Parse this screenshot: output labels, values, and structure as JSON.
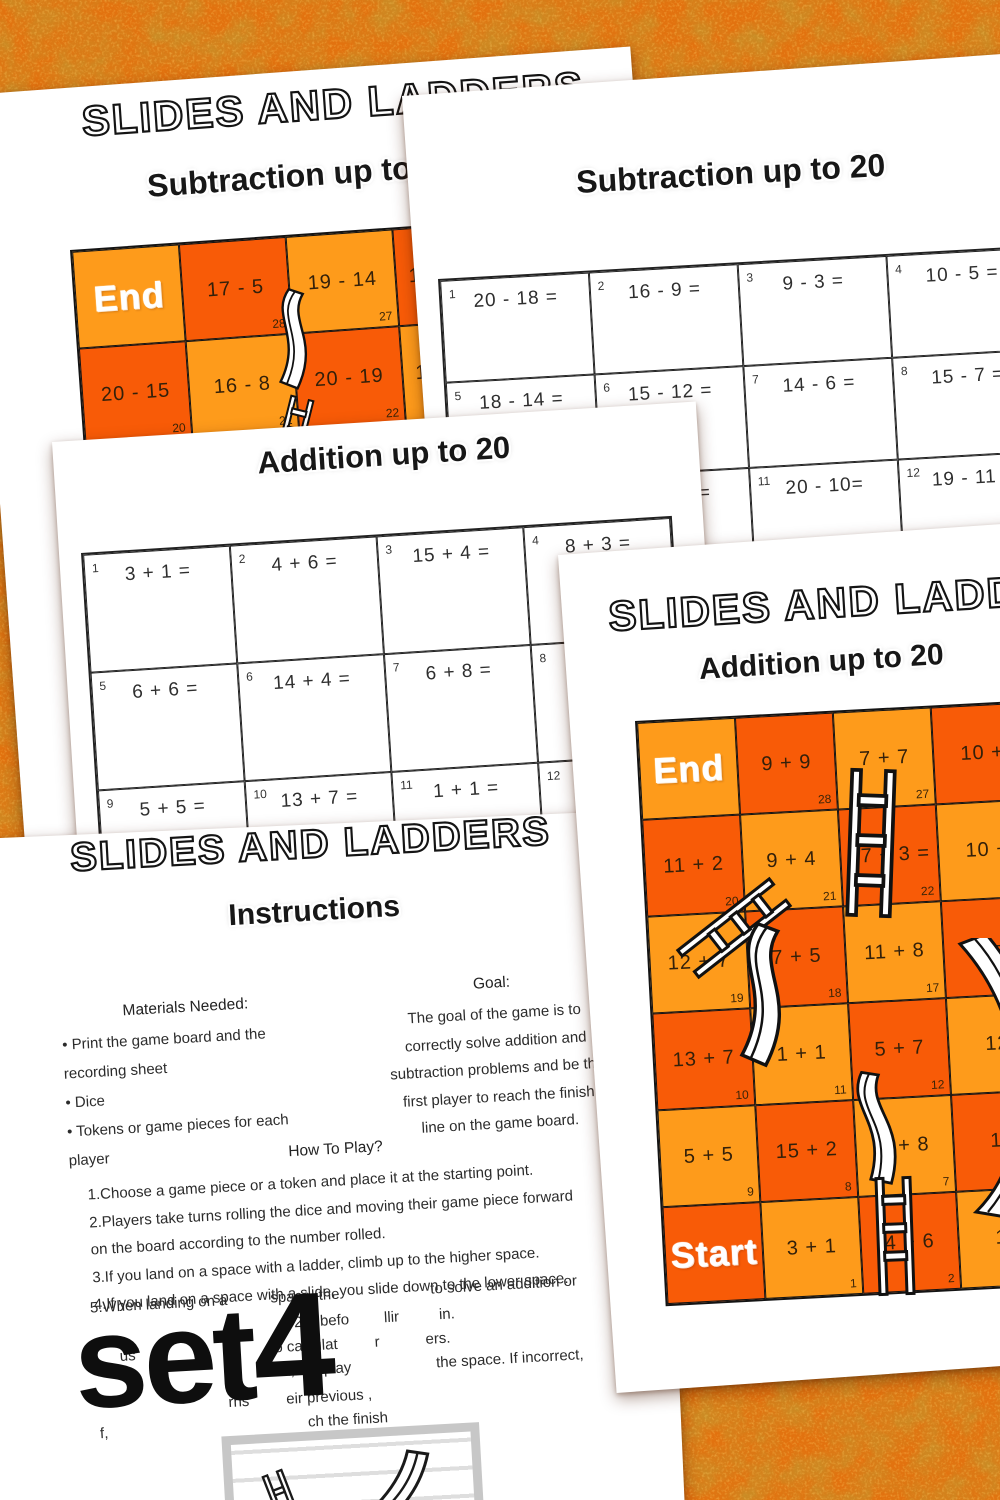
{
  "colors": {
    "background_base": "#DD6E10",
    "cell_light": "#FE9B1B",
    "cell_dark": "#F85B07",
    "board_border": "#141414",
    "page": "#ffffff",
    "ink": "#2b2b2b"
  },
  "page_board_sub": {
    "title": "SLIDES AND LADDERS",
    "subtitle": "Subtraction up to 20",
    "rows": [
      [
        {
          "t": "End",
          "shade": "light",
          "cls": "se"
        },
        {
          "t": "17 - 5",
          "shade": "dark",
          "n": "28"
        },
        {
          "t": "19 - 14",
          "shade": "light",
          "n": "27"
        },
        {
          "t": "17 -",
          "shade": "dark",
          "cls": "fl"
        }
      ],
      [
        {
          "t": "20 - 15",
          "shade": "dark",
          "n": "20"
        },
        {
          "t": "16 - 8",
          "shade": "light",
          "n": "21"
        },
        {
          "t": "20 - 19",
          "shade": "dark",
          "n": "22"
        },
        {
          "t": "18",
          "shade": "light",
          "cls": "fl"
        }
      ],
      [
        {
          "t": "",
          "shade": "light"
        },
        {
          "t": "",
          "shade": "dark"
        },
        {
          "t": "",
          "shade": "light"
        },
        {
          "t": "",
          "shade": "dark"
        }
      ]
    ]
  },
  "page_sheet_sub": {
    "title": "Subtraction up to 20",
    "rows": [
      [
        {
          "n": "1",
          "p": "20 - 18 ="
        },
        {
          "n": "2",
          "p": "16 - 9 ="
        },
        {
          "n": "3",
          "p": "9 - 3 ="
        },
        {
          "n": "4",
          "p": "10 - 5 ="
        }
      ],
      [
        {
          "n": "5",
          "p": "18 - 14 ="
        },
        {
          "n": "6",
          "p": "15 - 12 ="
        },
        {
          "n": "7",
          "p": "14 - 6 ="
        },
        {
          "n": "8",
          "p": "15 - 7 ="
        }
      ],
      [
        {
          "n": "9",
          "p": ""
        },
        {
          "n": "10",
          "p": "=",
          "cls": "shift"
        },
        {
          "n": "11",
          "p": "20 - 10="
        },
        {
          "n": "12",
          "p": "19 - 11 ="
        }
      ]
    ]
  },
  "page_sheet_add": {
    "title": "Addition up to 20",
    "rows": [
      [
        {
          "n": "1",
          "p": "3 + 1  ="
        },
        {
          "n": "2",
          "p": "4 + 6 ="
        },
        {
          "n": "3",
          "p": "15 + 4 ="
        },
        {
          "n": "4",
          "p": "8 + 3 ="
        }
      ],
      [
        {
          "n": "5",
          "p": "6 + 6 ="
        },
        {
          "n": "6",
          "p": "14 + 4 ="
        },
        {
          "n": "7",
          "p": "6 + 8 ="
        },
        {
          "n": "8",
          "p": ""
        }
      ],
      [
        {
          "n": "9",
          "p": "5 + 5 ="
        },
        {
          "n": "10",
          "p": "13 + 7 ="
        },
        {
          "n": "11",
          "p": "1 + 1 ="
        },
        {
          "n": "12",
          "p": ""
        }
      ]
    ]
  },
  "page_board_add": {
    "title": "SLIDES AND LADDERS",
    "subtitle": "Addition up to 20",
    "rows": [
      [
        {
          "t": "End",
          "shade": "light",
          "cls": "se"
        },
        {
          "t": "9 + 9",
          "shade": "dark",
          "n": "28"
        },
        {
          "t": "7 + 7",
          "shade": "light",
          "n": "27"
        },
        {
          "t": "10 +",
          "shade": "dark"
        }
      ],
      [
        {
          "t": "11 + 2",
          "shade": "dark",
          "n": "20"
        },
        {
          "t": "9 + 4",
          "shade": "light",
          "n": "21"
        },
        {
          "t": "17 + 3 =",
          "shade": "dark",
          "n": "22"
        },
        {
          "t": "10 +",
          "shade": "light"
        }
      ],
      [
        {
          "t": "12 + 7",
          "shade": "light",
          "n": "19"
        },
        {
          "t": "7 + 5",
          "shade": "dark",
          "n": "18"
        },
        {
          "t": "11 + 8",
          "shade": "light",
          "n": "17"
        },
        {
          "t": "6 +",
          "shade": "dark"
        }
      ],
      [
        {
          "t": "13 + 7",
          "shade": "dark",
          "n": "10"
        },
        {
          "t": "1 + 1",
          "shade": "light",
          "n": "11"
        },
        {
          "t": "5 + 7",
          "shade": "dark",
          "n": "12"
        },
        {
          "t": "12",
          "shade": "light"
        }
      ],
      [
        {
          "t": "5 + 5",
          "shade": "light",
          "n": "9"
        },
        {
          "t": "15 + 2",
          "shade": "dark",
          "n": "8"
        },
        {
          "t": "6 + 8",
          "shade": "light",
          "n": "7"
        },
        {
          "t": "14",
          "shade": "dark"
        }
      ],
      [
        {
          "t": "Start",
          "shade": "dark",
          "cls": "se"
        },
        {
          "t": "3 + 1",
          "shade": "light",
          "n": "1"
        },
        {
          "t": "4 + 6",
          "shade": "dark",
          "n": "2"
        },
        {
          "t": "15",
          "shade": "light"
        }
      ]
    ]
  },
  "page_instructions": {
    "title": "SLIDES AND LADDERS",
    "subtitle": "Instructions",
    "materials": {
      "heading": "Materials Needed:",
      "lines": [
        "•  Print the game board and the",
        "    recording sheet",
        "•  Dice",
        "•  Tokens or game pieces for each",
        "    player"
      ]
    },
    "goal": {
      "heading": "Goal:",
      "lines": [
        "The goal of the game is to",
        "correctly solve addition and",
        "subtraction problems and be the",
        "first player to reach the finish",
        "line on the game board."
      ]
    },
    "how_to": {
      "heading": "How To Play?",
      "lines": [
        "1.Choose a game piece or a token and place it at the starting point.",
        "2.Players take turns rolling the dice and moving their game piece forward",
        "  on the board according to the number rolled.",
        "3.If you land on a space with a ladder, climb up to the higher space.",
        "4.If you land on a space with a slide, you slide down to the lower space."
      ]
    },
    "fragment_rows": [
      [
        {
          "t": "5.When landing on a"
        },
        {
          "g": 43
        },
        {
          "t": "space, the"
        },
        {
          "g": 91
        },
        {
          "t": "to solve an addition or"
        }
      ],
      [
        {
          "g": 203
        },
        {
          "t": "20) befo"
        },
        {
          "g": 35
        },
        {
          "t": "llir"
        },
        {
          "g": 40
        },
        {
          "t": "in."
        }
      ],
      [
        {
          "g": 27
        },
        {
          "t": "us"
        },
        {
          "g": 139
        },
        {
          "t": "o calculat"
        },
        {
          "g": 37
        },
        {
          "t": "r"
        },
        {
          "g": 46
        },
        {
          "t": "ers."
        }
      ],
      [
        {
          "g": 185
        },
        {
          "t": "ct, the play"
        },
        {
          "g": 85
        },
        {
          "t": "the space. If incorrect,"
        }
      ],
      [
        {
          "g": 133
        },
        {
          "t": "rns"
        },
        {
          "g": 37
        },
        {
          "t": "eir previous ,"
        }
      ],
      [
        {
          "g": 3
        },
        {
          "t": "f,"
        },
        {
          "g": 200
        },
        {
          "t": "ch the finish"
        }
      ]
    ],
    "set_label_word": "set",
    "set_label_number": "4"
  }
}
